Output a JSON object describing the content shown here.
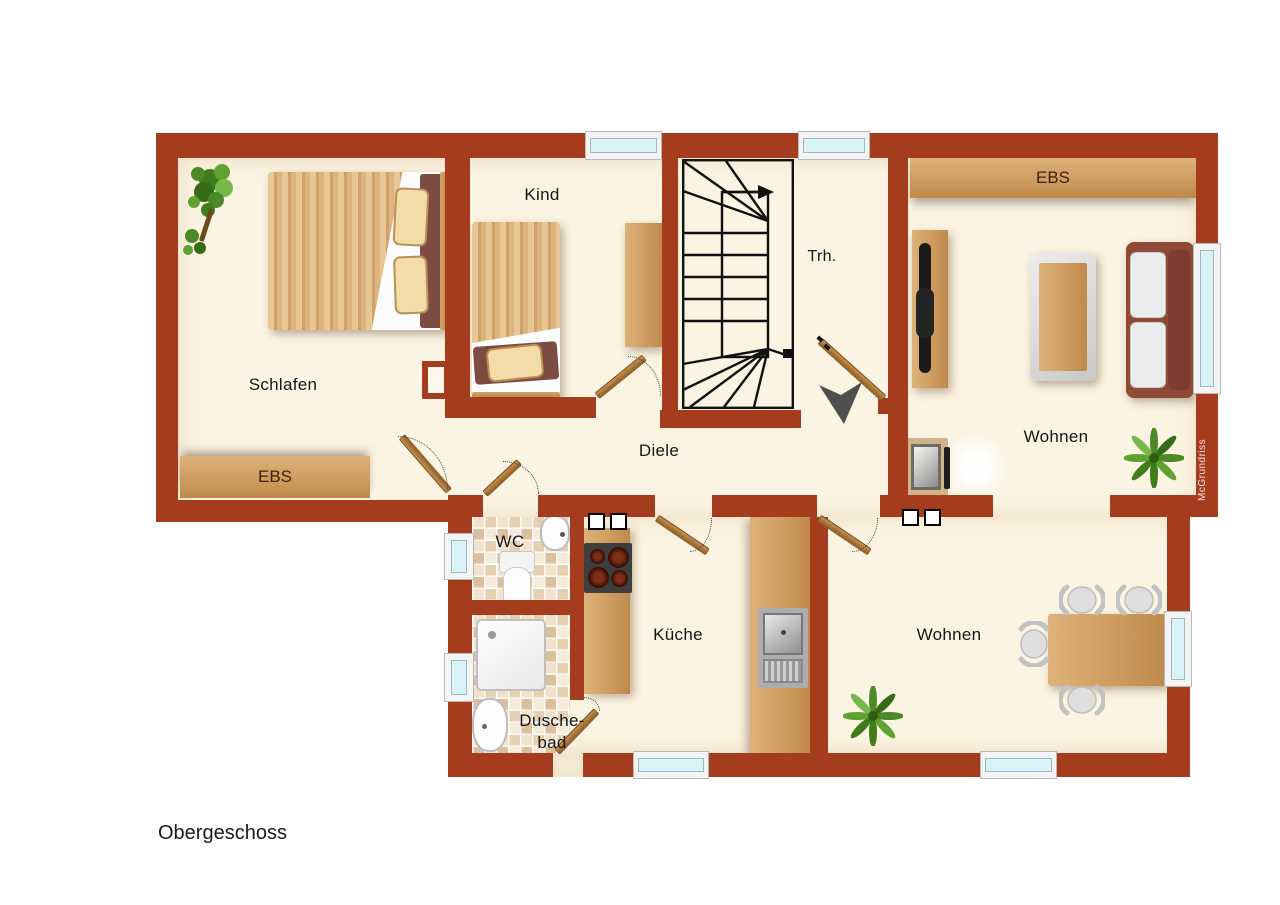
{
  "title": "Obergeschoss",
  "watermark": "McGrundriss",
  "rooms": {
    "schlafen": {
      "label": "Schlafen"
    },
    "kind": {
      "label": "Kind"
    },
    "trh": {
      "label": "Trh."
    },
    "diele": {
      "label": "Diele"
    },
    "wc": {
      "label": "WC"
    },
    "kueche": {
      "label": "Küche"
    },
    "duschebad": {
      "label_line1": "Dusche-",
      "label_line2": "bad"
    },
    "wohnen_top": {
      "label": "Wohnen"
    },
    "wohnen_bottom": {
      "label": "Wohnen"
    }
  },
  "closets": {
    "schlafen_label": "EBS",
    "wohnen_label": "EBS"
  },
  "colors": {
    "wall": "#A63C1E",
    "floor": "#FBF4E2",
    "window_glass": "#D8F2F8",
    "wood": "#CE9C5F",
    "plant_green": "#4C8A28",
    "arrow_gray": "#4F4F4F"
  }
}
